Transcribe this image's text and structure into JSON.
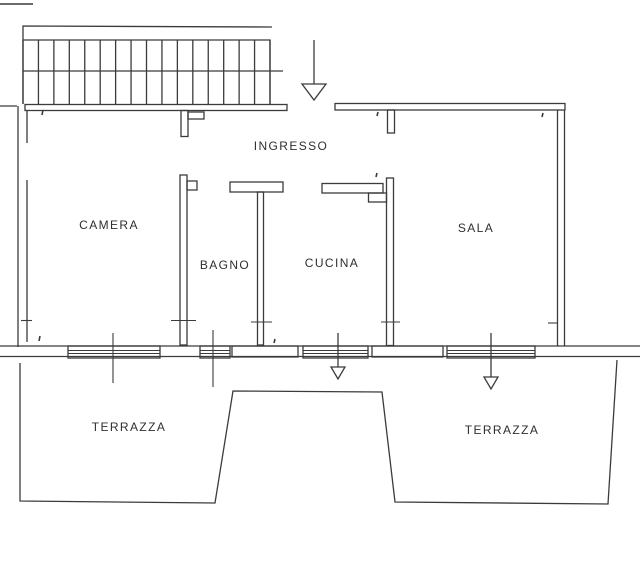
{
  "plan": {
    "labels": {
      "ingresso": "INGRESSO",
      "camera": "CAMERA",
      "bagno": "BAGNO",
      "cucina": "CUCINA",
      "sala": "SALA",
      "terrazza_left": "TERRAZZA",
      "terrazza_right": "TERRAZZA"
    },
    "stairs": {
      "riser_count": 17
    },
    "arrows": {
      "entrance": "down-arrow",
      "terrace_left": "down-arrow",
      "terrace_right": "down-arrow"
    },
    "colors": {
      "line": "#3b3b3b",
      "text": "#2f2f2f",
      "background": "#ffffff"
    }
  }
}
